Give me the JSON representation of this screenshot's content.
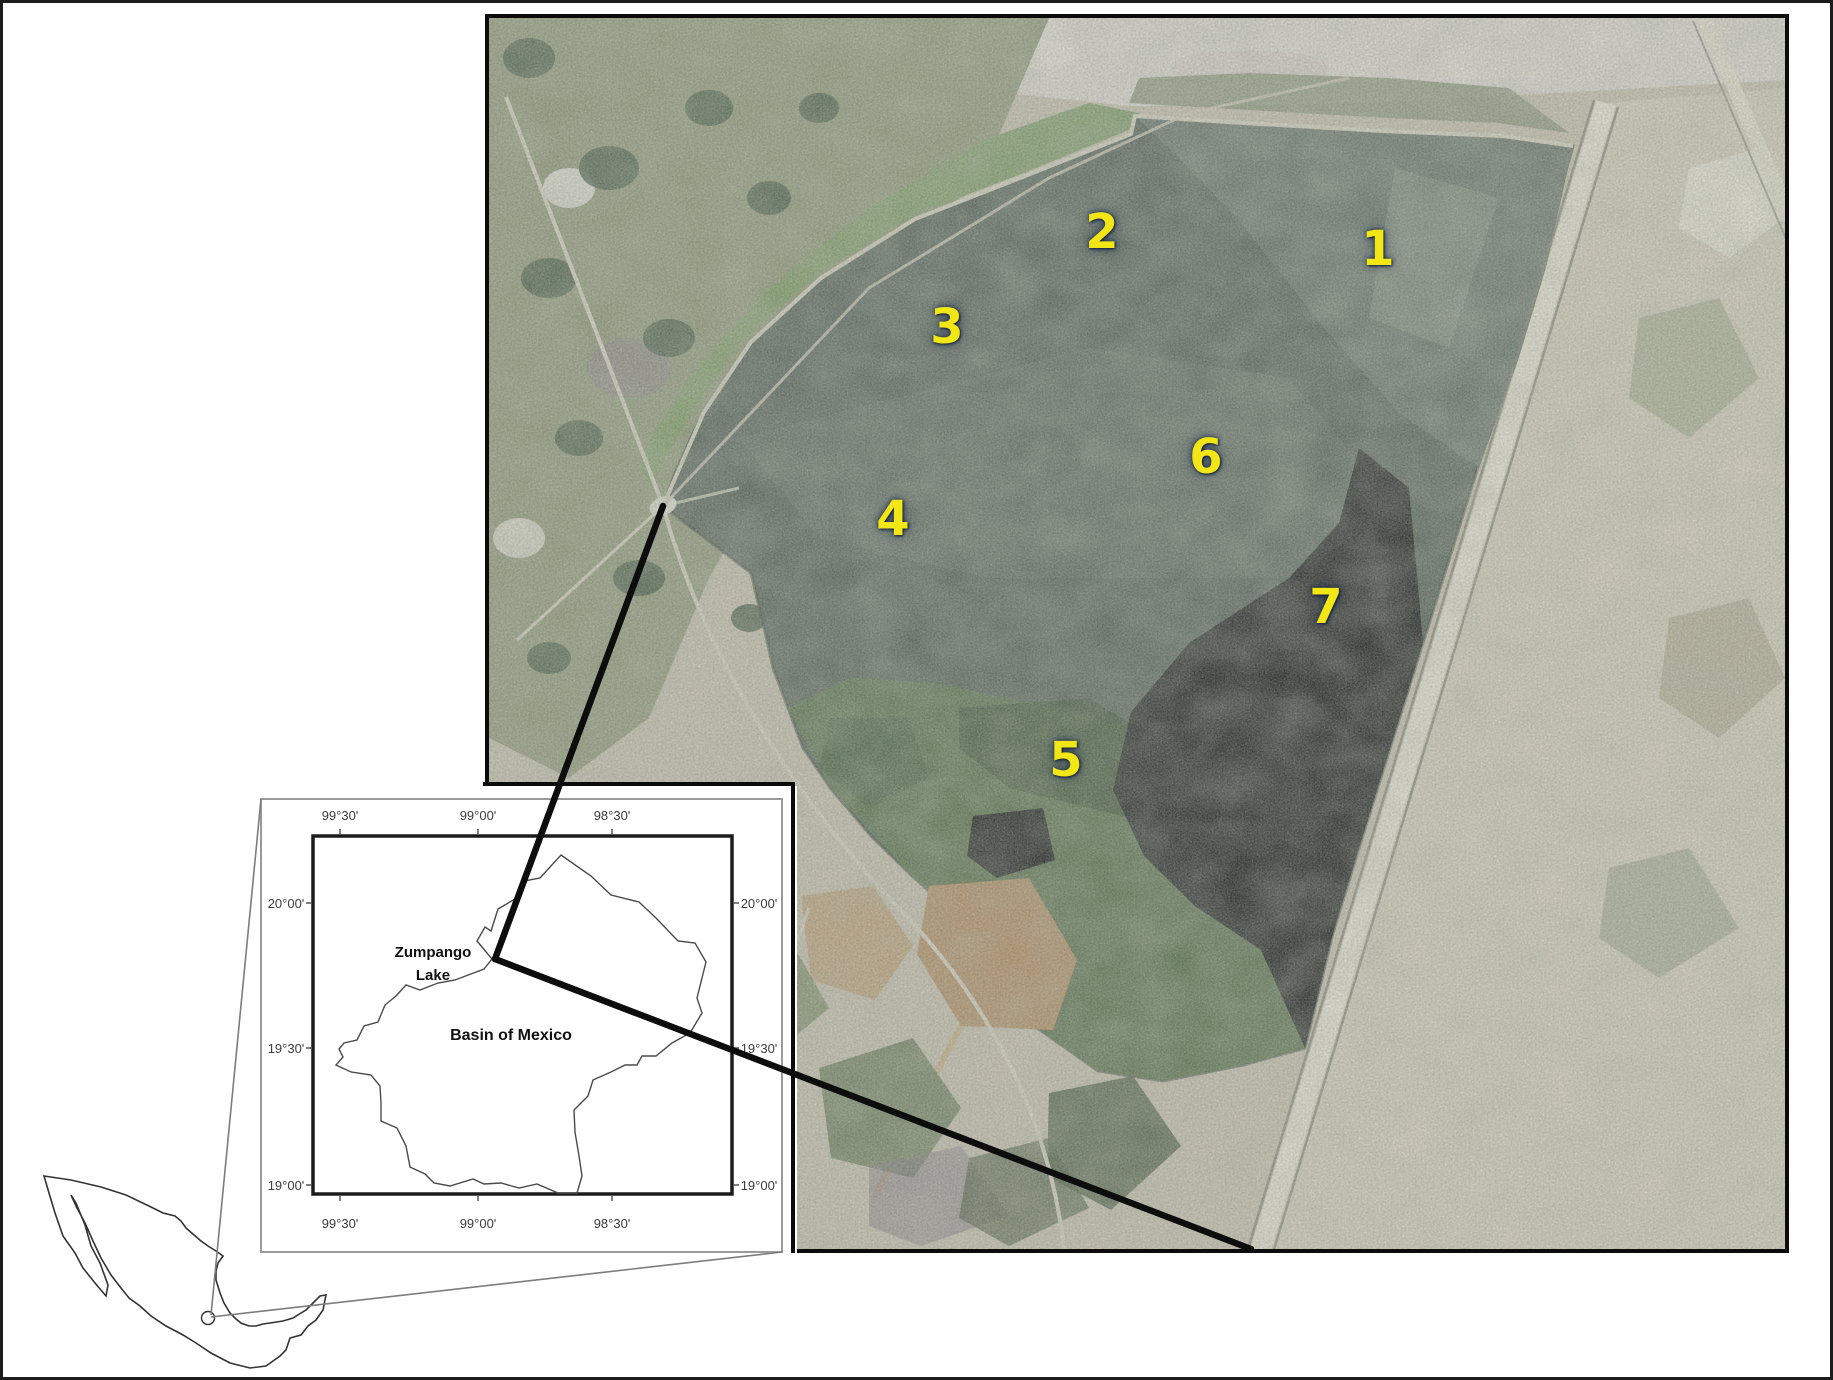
{
  "satellite_image": {
    "markers": [
      {
        "label": "1"
      },
      {
        "label": "2"
      },
      {
        "label": "3"
      },
      {
        "label": "4"
      },
      {
        "label": "5"
      },
      {
        "label": "6"
      },
      {
        "label": "7"
      }
    ],
    "marker_color": "#f2e714"
  },
  "inset_map": {
    "lon_labels": [
      "99°30'",
      "99°00'",
      "98°30'"
    ],
    "lat_labels": [
      "20°00'",
      "19°30'",
      "19°00'"
    ],
    "lake_label_line1": "Zumpango",
    "lake_label_line2": "Lake",
    "region_label": "Basin of Mexico"
  },
  "colors": {
    "marker_yellow": "#f2e714",
    "connector_line": "#0d0d0d",
    "thin_line": "#7d7d7d"
  }
}
